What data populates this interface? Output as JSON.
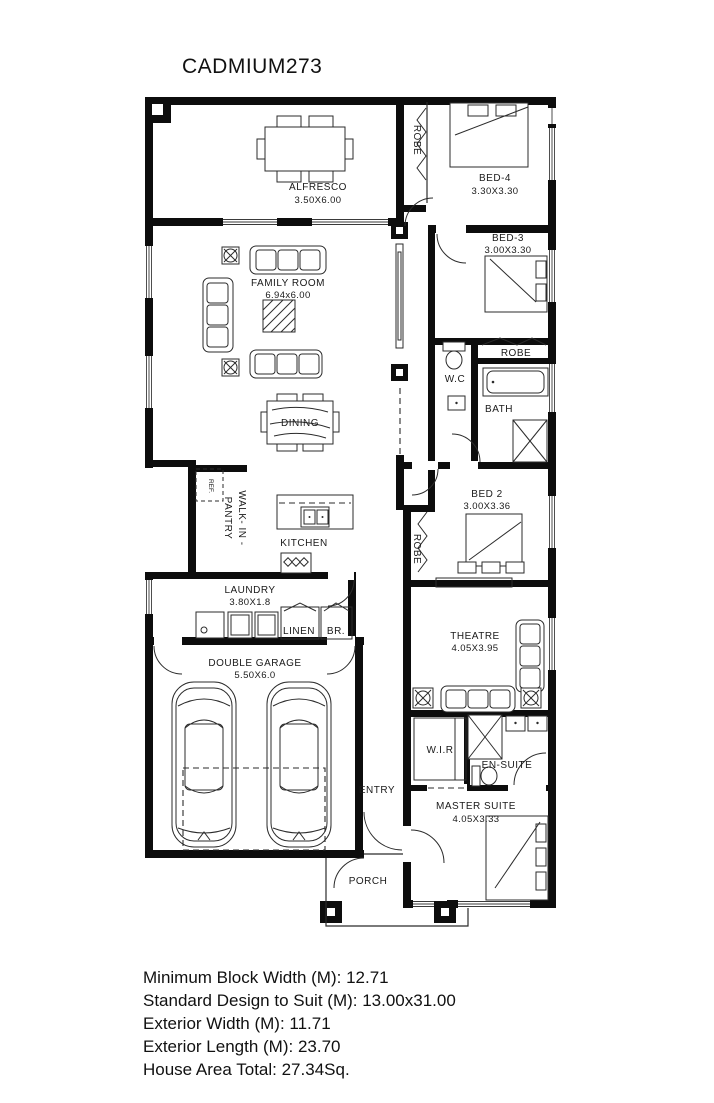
{
  "title": "CADMIUM273",
  "rooms": {
    "alfresco": {
      "name": "ALFRESCO",
      "dims": "3.50X6.00"
    },
    "bed4": {
      "name": "BED-4",
      "dims": "3.30X3.30"
    },
    "robe_bed4": {
      "name": "ROBE"
    },
    "bed3": {
      "name": "BED-3",
      "dims": "3.00X3.30"
    },
    "family": {
      "name": "FAMILY ROOM",
      "dims": "6.94x6.00"
    },
    "wc": {
      "name": "W.C"
    },
    "robe_bath": {
      "name": "ROBE"
    },
    "bath": {
      "name": "BATH"
    },
    "dining": {
      "name": "DINING"
    },
    "bed2": {
      "name": "BED 2",
      "dims": "3.00X3.36"
    },
    "robe_bed2": {
      "name": "ROBE"
    },
    "pantry": {
      "line1": "WALK- IN -",
      "line2": "PANTRY"
    },
    "ref": {
      "name": "REF."
    },
    "kitchen": {
      "name": "KITCHEN"
    },
    "laundry": {
      "name": "LAUNDRY",
      "dims": "3.80X1.8"
    },
    "linen": {
      "name": "LINEN"
    },
    "br": {
      "name": "BR."
    },
    "garage": {
      "name": "DOUBLE GARAGE",
      "dims": "5.50X6.0"
    },
    "theatre": {
      "name": "THEATRE",
      "dims": "4.05X3.95"
    },
    "wir": {
      "name": "W.I.R"
    },
    "ensuite": {
      "name": "EN-SUITE"
    },
    "entry": {
      "name": "ENTRY"
    },
    "master": {
      "name": "MASTER SUITE",
      "dims": "4.05X3.33"
    },
    "porch": {
      "name": "PORCH"
    }
  },
  "specs": {
    "min_block_width": "Minimum Block Width (M): 12.71",
    "standard_design": "Standard Design to Suit (M): 13.00x31.00",
    "exterior_width": "Exterior Width (M): 11.71",
    "exterior_length": "Exterior Length (M): 23.70",
    "house_area": "House Area Total: 27.34Sq."
  }
}
